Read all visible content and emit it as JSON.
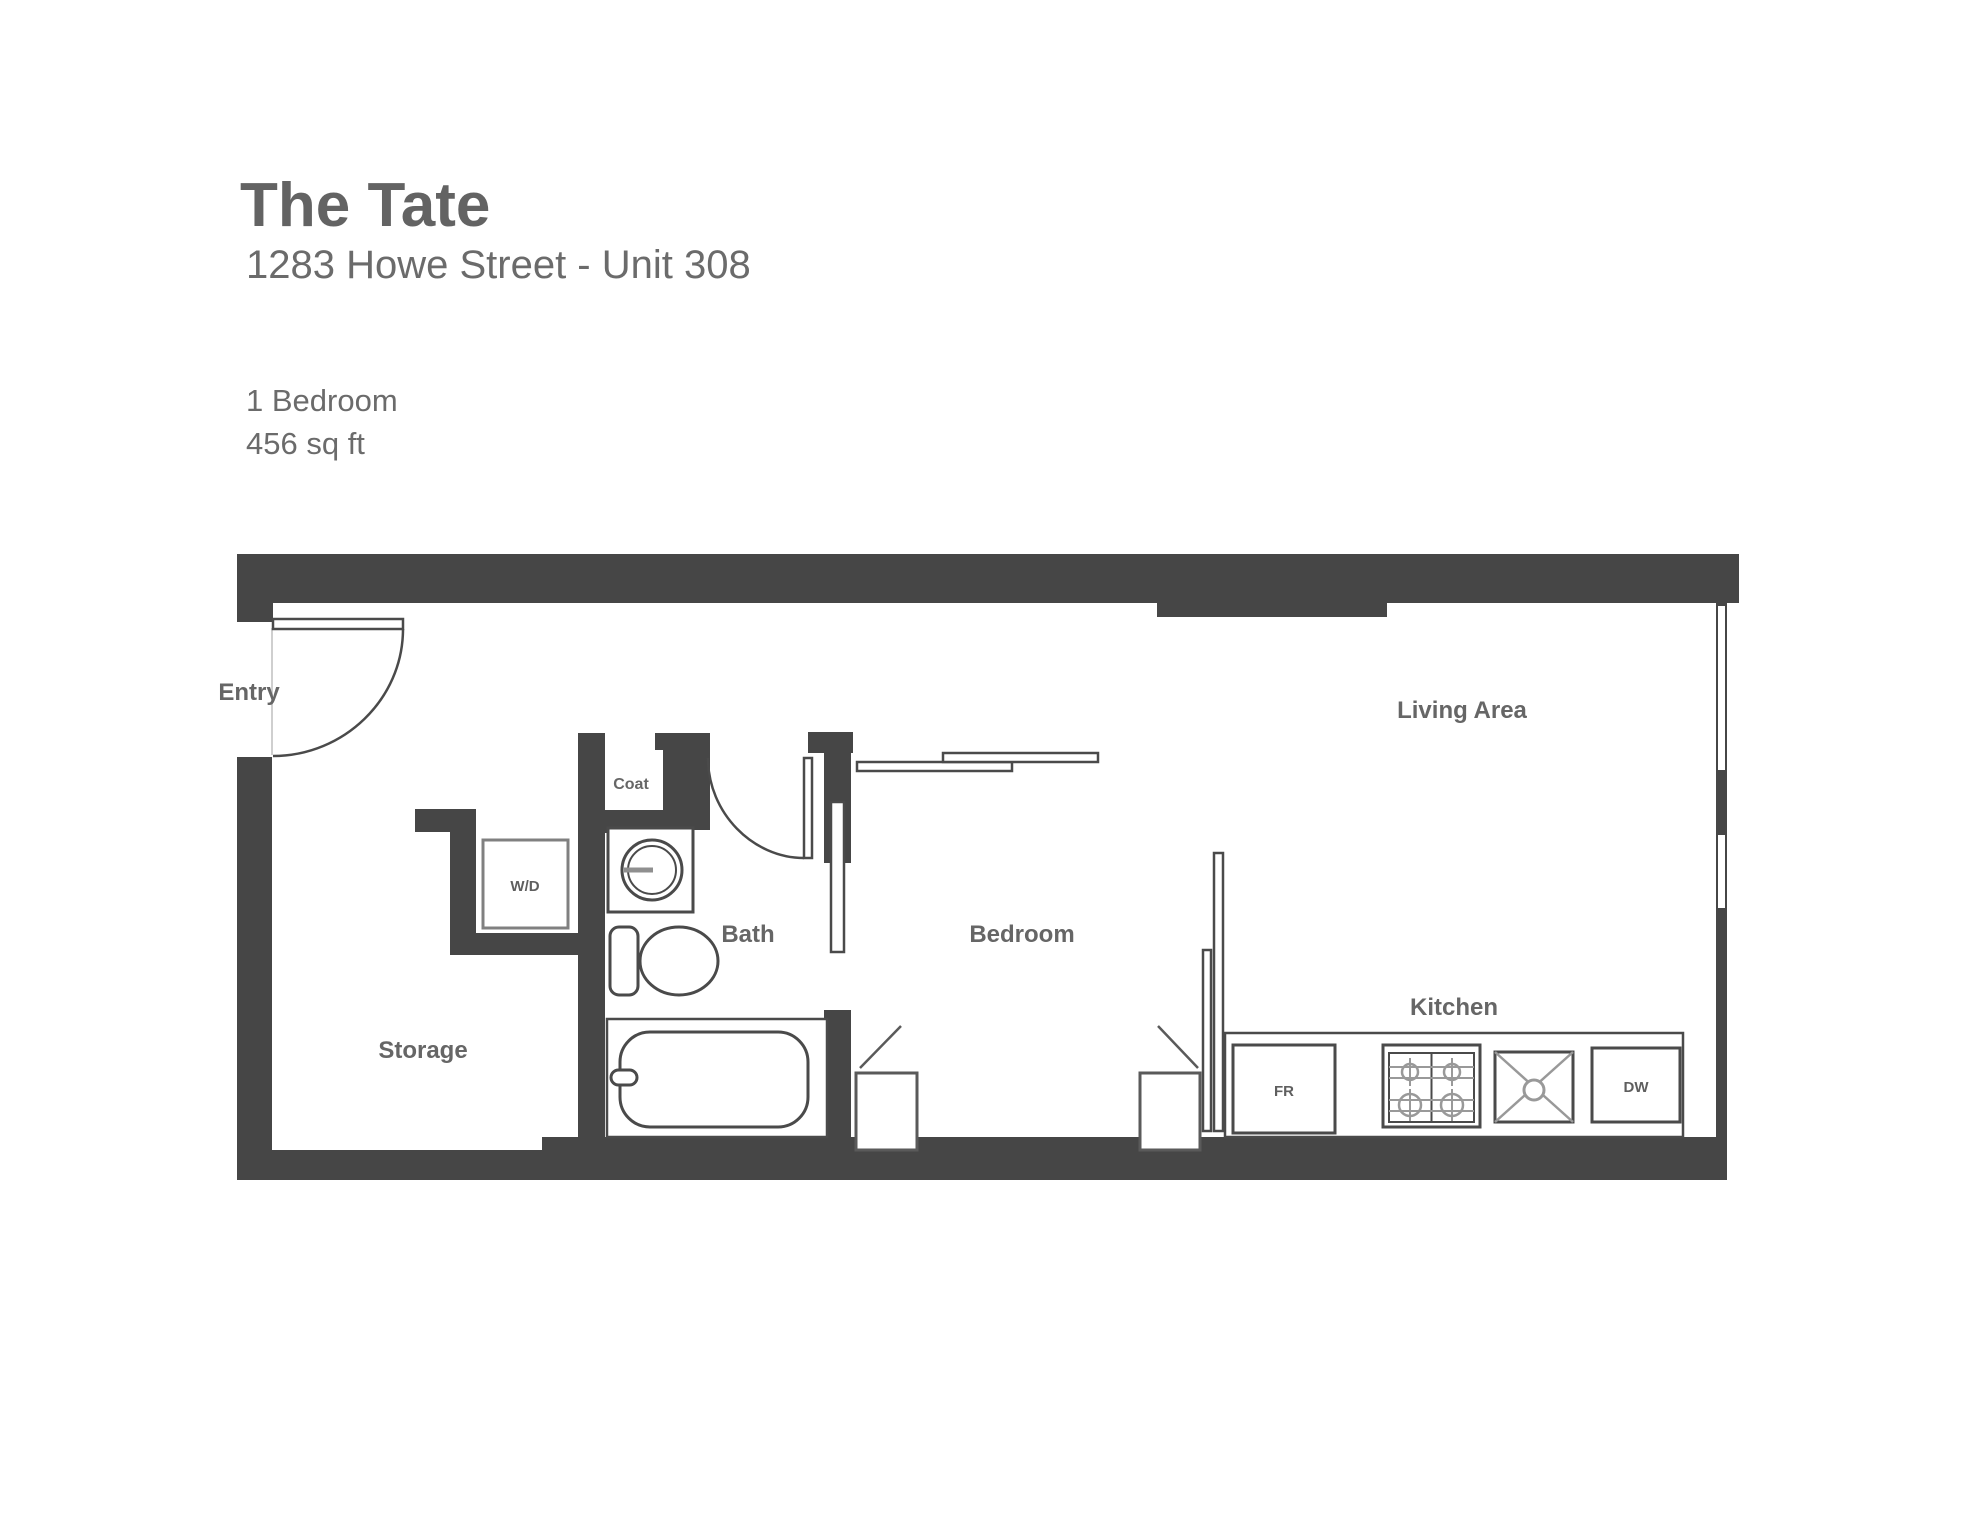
{
  "header": {
    "building_name": "The Tate",
    "address": "1283 Howe Street - Unit 308",
    "bedrooms": "1 Bedroom",
    "area": "456 sq ft"
  },
  "floorplan": {
    "rooms": {
      "entry": "Entry",
      "storage": "Storage",
      "coat": "Coat",
      "bath": "Bath",
      "bedroom": "Bedroom",
      "living_area": "Living Area",
      "kitchen": "Kitchen"
    },
    "fixtures": {
      "washer_dryer": "W/D",
      "fridge": "FR",
      "dishwasher": "DW"
    },
    "colors": {
      "wall": "#464646",
      "outline": "#4a4a4a",
      "detail_gray": "#999999",
      "label": "#666666",
      "title": "#636363",
      "subtitle": "#6b6b6b"
    }
  }
}
